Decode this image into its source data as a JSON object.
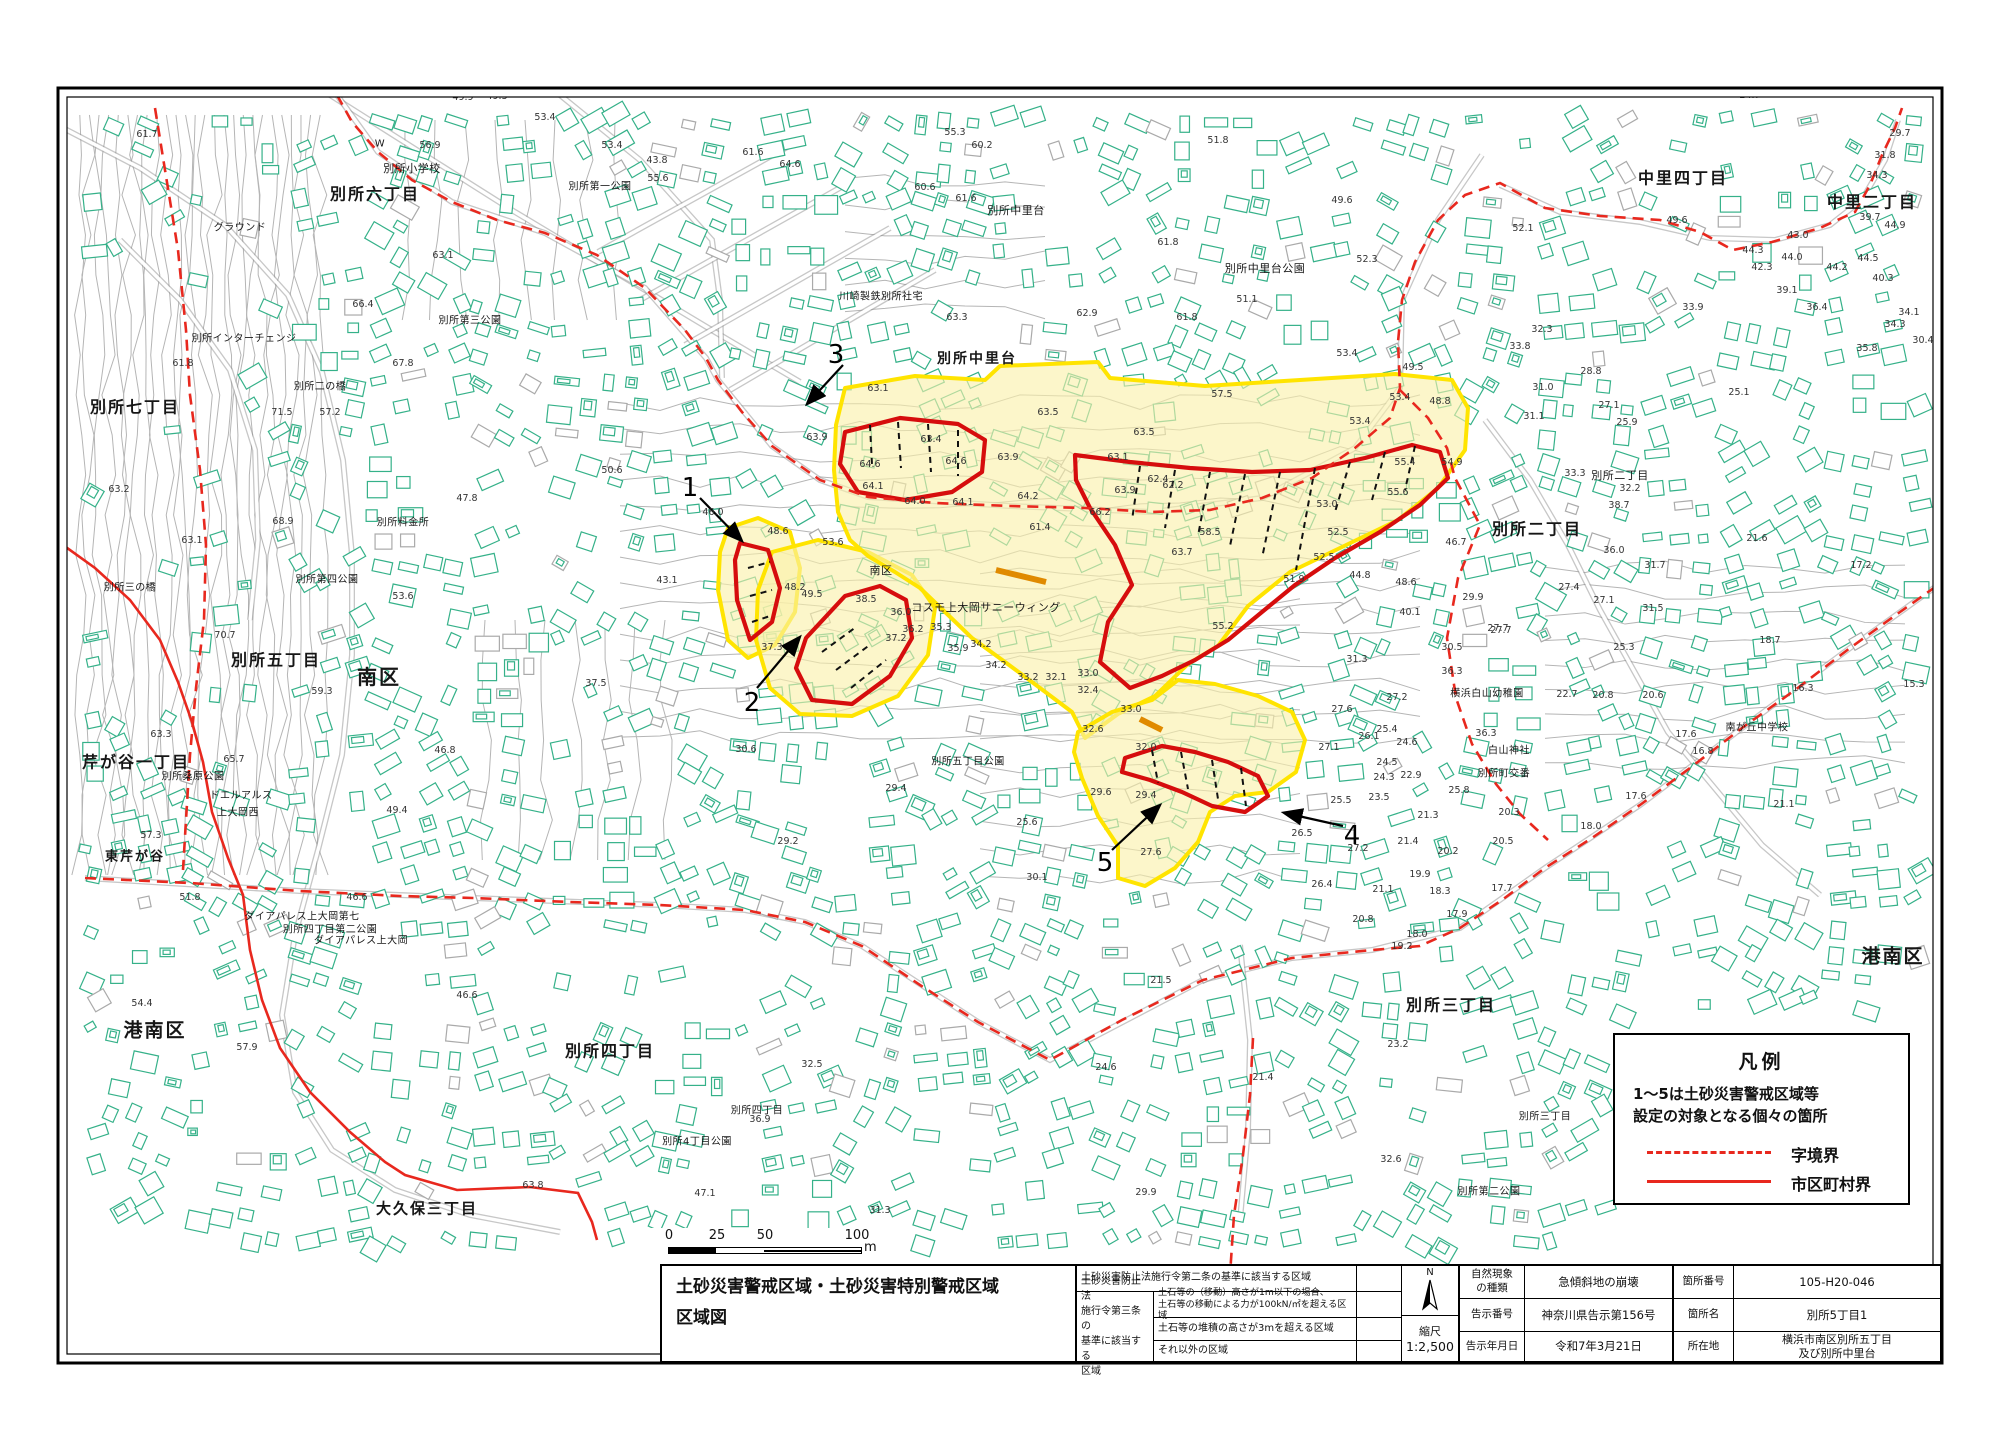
{
  "title": "土砂災害警戒区域等指定図（その2）",
  "scale_bar": {
    "t0": "0",
    "t25": "25",
    "t50": "50",
    "t100": "100",
    "unit": "m"
  },
  "legend_box": {
    "title": "凡例",
    "desc_line1": "1～5は土砂災害警戒区域等",
    "desc_line2": "設定の対象となる個々の箇所",
    "dashed_label": "字境界",
    "solid_label": "市区町村界"
  },
  "info_table": {
    "map_title_lines": [
      "土砂災害警戒区域・土砂災害特別警戒区域",
      "区域図"
    ],
    "row_article2": "土砂災害防止法施行令第二条の基準に該当する区域",
    "group_lines": [
      "土砂災害防止法",
      "施行令第三条の",
      "基準に該当する",
      "区域"
    ],
    "row_move_lines": [
      "土石等の（移動）高さが1m以下の場合、",
      "土石等の移動による力が100kN/㎡を超える区域"
    ],
    "row_deposit": "土石等の堆積の高さが3mを超える区域",
    "row_other": "それ以外の区域",
    "north_label": "N",
    "scale_label": "縮尺",
    "scale_value": "1:2,500",
    "nature_lines": [
      "自然現象",
      "の種類"
    ],
    "nature_value": "急傾斜地の崩壊",
    "notice_label": "告示番号",
    "notice_value": "神奈川県告示第156号",
    "date_label": "告示年月日",
    "date_value": "令和7年3月21日",
    "siteno_label": "箇所番号",
    "siteno_value": "105-H20-046",
    "sitename_label": "箇所名",
    "sitename_value": "別所5丁目1",
    "loc_label": "所在地",
    "loc_lines": [
      "横浜市南区別所五丁目",
      "及び別所中里台"
    ]
  },
  "map": {
    "area_labels": [
      [
        "別所小学校",
        412,
        168,
        11,
        0
      ],
      [
        "別所六丁目",
        375,
        194,
        16,
        1
      ],
      [
        "グラウンド",
        240,
        227,
        10,
        0
      ],
      [
        "別所第一公園",
        600,
        186,
        10,
        0
      ],
      [
        "別所第三公園",
        470,
        320,
        10,
        0
      ],
      [
        "別所インターチェンジ",
        244,
        338,
        10,
        0
      ],
      [
        "別所二の橋",
        320,
        386,
        10,
        0
      ],
      [
        "別所七丁目",
        135,
        407,
        16,
        1
      ],
      [
        "別所料金所",
        403,
        522,
        10,
        0
      ],
      [
        "別所第四公園",
        327,
        579,
        10,
        0
      ],
      [
        "別所三の橋",
        130,
        587,
        10,
        0
      ],
      [
        "別所五丁目",
        276,
        660,
        16,
        1
      ],
      [
        "南区",
        379,
        677,
        20,
        1
      ],
      [
        "芹が谷一丁目",
        136,
        762,
        16,
        1
      ],
      [
        "別所桑原公園",
        193,
        776,
        10,
        0
      ],
      [
        "ドエルアルス",
        241,
        795,
        10,
        0
      ],
      [
        "上大岡西",
        238,
        812,
        10,
        0
      ],
      [
        "東芹が谷",
        135,
        856,
        13,
        1
      ],
      [
        "ダイアパレス上大岡第七",
        302,
        916,
        10,
        0
      ],
      [
        "別所四丁目第二公園",
        330,
        929,
        10,
        0
      ],
      [
        "ダイアパレス上大岡",
        361,
        940,
        10,
        0
      ],
      [
        "港南区",
        155,
        1030,
        19,
        1
      ],
      [
        "大久保三丁目",
        427,
        1208,
        15,
        1
      ],
      [
        "別所四丁目",
        610,
        1051,
        16,
        1
      ],
      [
        "別所四丁目",
        757,
        1110,
        10,
        0
      ],
      [
        "別所4丁目公園",
        697,
        1141,
        10,
        0
      ],
      [
        "川崎製鉄別所社宅",
        881,
        296,
        10,
        0
      ],
      [
        "別所中里台",
        1016,
        210,
        11,
        0
      ],
      [
        "別所中里台",
        977,
        358,
        14,
        1
      ],
      [
        "別所中里台公園",
        1265,
        268,
        11,
        0
      ],
      [
        "コスモ上大岡サニーウィング",
        986,
        607,
        11,
        0
      ],
      [
        "南区",
        881,
        570,
        11,
        0
      ],
      [
        "別所五丁目公園",
        968,
        761,
        10,
        0
      ],
      [
        "横浜白山幼稚園",
        1487,
        693,
        10,
        0
      ],
      [
        "白山神社",
        1509,
        750,
        10,
        0
      ],
      [
        "別所町交番",
        1504,
        773,
        10,
        0
      ],
      [
        "南が丘中学校",
        1757,
        727,
        10,
        0
      ],
      [
        "中里四丁目",
        1683,
        178,
        16,
        1
      ],
      [
        "中里二丁目",
        1872,
        202,
        16,
        1
      ],
      [
        "別所二丁目",
        1537,
        529,
        16,
        1
      ],
      [
        "別所二丁目",
        1620,
        475,
        11,
        0
      ],
      [
        "別所三丁目",
        1451,
        1005,
        16,
        1
      ],
      [
        "別所三丁目",
        1545,
        1116,
        10,
        0
      ],
      [
        "別所第二公園",
        1489,
        1191,
        10,
        0
      ],
      [
        "港南区",
        1893,
        956,
        19,
        1
      ],
      [
        "W",
        380,
        143,
        10,
        0
      ]
    ],
    "spot_heights": [
      [
        "61.7",
        147,
        137
      ],
      [
        "56.9",
        430,
        148
      ],
      [
        "49.9",
        463,
        100
      ],
      [
        "49.3",
        497,
        99
      ],
      [
        "53.4",
        545,
        120
      ],
      [
        "53.4",
        612,
        148
      ],
      [
        "43.8",
        657,
        163
      ],
      [
        "55.6",
        658,
        181
      ],
      [
        "61.6",
        753,
        155
      ],
      [
        "64.6",
        790,
        167
      ],
      [
        "24.7",
        1750,
        98
      ],
      [
        "55.3",
        955,
        135
      ],
      [
        "60.2",
        982,
        148
      ],
      [
        "60.6",
        925,
        190
      ],
      [
        "61.6",
        966,
        201
      ],
      [
        "51.8",
        1218,
        143
      ],
      [
        "61.8",
        1168,
        245
      ],
      [
        "51.1",
        1247,
        302
      ],
      [
        "61.8",
        1187,
        320
      ],
      [
        "62.9",
        1087,
        316
      ],
      [
        "63.3",
        957,
        320
      ],
      [
        "52.3",
        1367,
        262
      ],
      [
        "49.6",
        1342,
        203
      ],
      [
        "53.4",
        1347,
        356
      ],
      [
        "29.7",
        1900,
        136
      ],
      [
        "31.8",
        1885,
        158
      ],
      [
        "34.3",
        1877,
        178
      ],
      [
        "52.1",
        1523,
        231
      ],
      [
        "49.6",
        1677,
        223
      ],
      [
        "44.3",
        1753,
        253
      ],
      [
        "44.0",
        1792,
        260
      ],
      [
        "43.0",
        1798,
        238
      ],
      [
        "42.3",
        1762,
        270
      ],
      [
        "44.2",
        1837,
        270
      ],
      [
        "44.5",
        1868,
        261
      ],
      [
        "44.9",
        1895,
        228
      ],
      [
        "39.7",
        1870,
        220
      ],
      [
        "40.3",
        1883,
        281
      ],
      [
        "39.1",
        1787,
        293
      ],
      [
        "36.4",
        1817,
        310
      ],
      [
        "33.9",
        1693,
        310
      ],
      [
        "34.3",
        1895,
        327
      ],
      [
        "34.1",
        1909,
        315
      ],
      [
        "30.4",
        1923,
        343
      ],
      [
        "35.8",
        1867,
        351
      ],
      [
        "25.1",
        1739,
        395
      ],
      [
        "32.3",
        1542,
        332
      ],
      [
        "33.8",
        1520,
        349
      ],
      [
        "28.8",
        1591,
        374
      ],
      [
        "31.0",
        1543,
        390
      ],
      [
        "27.1",
        1609,
        408
      ],
      [
        "25.9",
        1627,
        425
      ],
      [
        "31.1",
        1534,
        419
      ],
      [
        "63.1",
        443,
        258
      ],
      [
        "66.4",
        363,
        307
      ],
      [
        "67.8",
        403,
        366
      ],
      [
        "61.8",
        183,
        366
      ],
      [
        "63.2",
        119,
        492
      ],
      [
        "63.1",
        192,
        543
      ],
      [
        "68.9",
        283,
        524
      ],
      [
        "71.5",
        282,
        415
      ],
      [
        "57.2",
        330,
        415
      ],
      [
        "53.6",
        403,
        599
      ],
      [
        "59.3",
        322,
        694
      ],
      [
        "70.7",
        225,
        638
      ],
      [
        "47.8",
        467,
        501
      ],
      [
        "63.3",
        161,
        737
      ],
      [
        "65.7",
        234,
        762
      ],
      [
        "57.3",
        151,
        838
      ],
      [
        "51.8",
        190,
        900
      ],
      [
        "46.6",
        357,
        900
      ],
      [
        "49.4",
        397,
        813
      ],
      [
        "46.8",
        445,
        753
      ],
      [
        "54.4",
        142,
        1006
      ],
      [
        "57.9",
        247,
        1050
      ],
      [
        "46.6",
        467,
        998
      ],
      [
        "63.8",
        533,
        1188
      ],
      [
        "50.6",
        612,
        473
      ],
      [
        "46.0",
        713,
        515
      ],
      [
        "48.6",
        778,
        534
      ],
      [
        "43.1",
        667,
        583
      ],
      [
        "53.6",
        833,
        545
      ],
      [
        "37.5",
        596,
        686
      ],
      [
        "63.1",
        878,
        391
      ],
      [
        "63.9",
        817,
        440
      ],
      [
        "64.6",
        870,
        467
      ],
      [
        "64.1",
        873,
        489
      ],
      [
        "64.0",
        915,
        504
      ],
      [
        "64.1",
        963,
        505
      ],
      [
        "63.4",
        931,
        442
      ],
      [
        "64.6",
        956,
        464
      ],
      [
        "63.9",
        1008,
        460
      ],
      [
        "63.5",
        1048,
        415
      ],
      [
        "61.4",
        1040,
        530
      ],
      [
        "64.2",
        1028,
        499
      ],
      [
        "48.2",
        795,
        590
      ],
      [
        "49.5",
        812,
        597
      ],
      [
        "38.5",
        866,
        602
      ],
      [
        "36.0",
        901,
        615
      ],
      [
        "36.2",
        913,
        632
      ],
      [
        "37.2",
        896,
        641
      ],
      [
        "35.3",
        941,
        630
      ],
      [
        "35.9",
        958,
        651
      ],
      [
        "34.2",
        981,
        647
      ],
      [
        "34.2",
        996,
        668
      ],
      [
        "33.2",
        1028,
        680
      ],
      [
        "32.1",
        1056,
        680
      ],
      [
        "33.0",
        1088,
        676
      ],
      [
        "32.4",
        1088,
        693
      ],
      [
        "33.0",
        1131,
        712
      ],
      [
        "32.6",
        1093,
        732
      ],
      [
        "32.0",
        1146,
        750
      ],
      [
        "37.3",
        772,
        650
      ],
      [
        "30.6",
        746,
        752
      ],
      [
        "29.4",
        896,
        791
      ],
      [
        "29.2",
        788,
        844
      ],
      [
        "25.6",
        1027,
        825
      ],
      [
        "29.6",
        1101,
        795
      ],
      [
        "29.4",
        1146,
        798
      ],
      [
        "27.6",
        1151,
        855
      ],
      [
        "30.1",
        1037,
        880
      ],
      [
        "58.5",
        1210,
        535
      ],
      [
        "63.7",
        1182,
        555
      ],
      [
        "55.2",
        1223,
        629
      ],
      [
        "52.5",
        1324,
        560
      ],
      [
        "51.9",
        1294,
        582
      ],
      [
        "52.5",
        1338,
        535
      ],
      [
        "44.8",
        1360,
        578
      ],
      [
        "48.6",
        1406,
        585
      ],
      [
        "40.1",
        1410,
        615
      ],
      [
        "29.9",
        1473,
        600
      ],
      [
        "27.7",
        1498,
        631
      ],
      [
        "31.3",
        1357,
        662
      ],
      [
        "36.3",
        1452,
        674
      ],
      [
        "27.2",
        1397,
        700
      ],
      [
        "27.6",
        1342,
        712
      ],
      [
        "25.4",
        1387,
        732
      ],
      [
        "26.1",
        1369,
        739
      ],
      [
        "27.1",
        1329,
        750
      ],
      [
        "24.6",
        1407,
        745
      ],
      [
        "24.5",
        1387,
        765
      ],
      [
        "24.3",
        1384,
        780
      ],
      [
        "22.9",
        1411,
        778
      ],
      [
        "23.5",
        1379,
        800
      ],
      [
        "25.5",
        1341,
        803
      ],
      [
        "21.3",
        1428,
        818
      ],
      [
        "25.8",
        1459,
        793
      ],
      [
        "20.3",
        1509,
        815
      ],
      [
        "30.5",
        1452,
        650
      ],
      [
        "46.7",
        1456,
        545
      ],
      [
        "21.4",
        1408,
        844
      ],
      [
        "20.2",
        1448,
        854
      ],
      [
        "19.9",
        1420,
        877
      ],
      [
        "26.4",
        1322,
        887
      ],
      [
        "21.1",
        1383,
        892
      ],
      [
        "18.3",
        1440,
        894
      ],
      [
        "17.7",
        1502,
        891
      ],
      [
        "20.8",
        1363,
        922
      ],
      [
        "17.9",
        1457,
        917
      ],
      [
        "18.0",
        1417,
        937
      ],
      [
        "19.2",
        1402,
        949
      ],
      [
        "26.5",
        1302,
        836
      ],
      [
        "27.2",
        1358,
        851
      ],
      [
        "20.5",
        1503,
        844
      ],
      [
        "57.5",
        1222,
        397
      ],
      [
        "63.5",
        1144,
        435
      ],
      [
        "63.1",
        1118,
        460
      ],
      [
        "62.4",
        1158,
        482
      ],
      [
        "62.2",
        1173,
        488
      ],
      [
        "63.9",
        1125,
        493
      ],
      [
        "66.2",
        1100,
        515
      ],
      [
        "49.5",
        1413,
        370
      ],
      [
        "53.4",
        1400,
        400
      ],
      [
        "53.4",
        1360,
        424
      ],
      [
        "48.8",
        1440,
        404
      ],
      [
        "55.4",
        1405,
        465
      ],
      [
        "54.9",
        1452,
        465
      ],
      [
        "55.6",
        1398,
        495
      ],
      [
        "53.0",
        1327,
        507
      ],
      [
        "21.5",
        1161,
        983
      ],
      [
        "24.6",
        1106,
        1070
      ],
      [
        "21.4",
        1263,
        1080
      ],
      [
        "23.2",
        1398,
        1047
      ],
      [
        "32.6",
        1391,
        1162
      ],
      [
        "29.9",
        1146,
        1195
      ],
      [
        "20.6",
        1653,
        698
      ],
      [
        "20.8",
        1603,
        698
      ],
      [
        "22.7",
        1567,
        697
      ],
      [
        "25.3",
        1624,
        650
      ],
      [
        "31.5",
        1653,
        611
      ],
      [
        "31.7",
        1655,
        568
      ],
      [
        "36.0",
        1614,
        553
      ],
      [
        "38.7",
        1619,
        508
      ],
      [
        "32.2",
        1630,
        491
      ],
      [
        "33.3",
        1575,
        476
      ],
      [
        "21.6",
        1757,
        541
      ],
      [
        "17.2",
        1861,
        568
      ],
      [
        "18.7",
        1770,
        643
      ],
      [
        "27.4",
        1569,
        590
      ],
      [
        "27.1",
        1604,
        603
      ],
      [
        "27.7",
        1501,
        633
      ],
      [
        "36.3",
        1486,
        736
      ],
      [
        "15.3",
        1914,
        687
      ],
      [
        "16.3",
        1803,
        691
      ],
      [
        "17.6",
        1686,
        737
      ],
      [
        "16.8",
        1703,
        754
      ],
      [
        "17.6",
        1636,
        799
      ],
      [
        "18.0",
        1591,
        829
      ],
      [
        "21.1",
        1784,
        807
      ],
      [
        "36.9",
        760,
        1122
      ],
      [
        "47.1",
        705,
        1196
      ],
      [
        "32.5",
        812,
        1067
      ],
      [
        "31.3",
        880,
        1213
      ]
    ],
    "markers": [
      {
        "n": "1",
        "x": 690,
        "y": 487,
        "x1": 700,
        "y1": 498,
        "x2": 741,
        "y2": 540
      },
      {
        "n": "2",
        "x": 752,
        "y": 702,
        "x1": 757,
        "y1": 688,
        "x2": 799,
        "y2": 638
      },
      {
        "n": "3",
        "x": 836,
        "y": 354,
        "x1": 843,
        "y1": 365,
        "x2": 808,
        "y2": 403
      },
      {
        "n": "4",
        "x": 1352,
        "y": 835,
        "x1": 1343,
        "y1": 826,
        "x2": 1285,
        "y2": 813
      },
      {
        "n": "5",
        "x": 1105,
        "y": 862,
        "x1": 1112,
        "y1": 850,
        "x2": 1159,
        "y2": 806
      }
    ],
    "colors": {
      "building": "#35b189",
      "contour": "#b5b5b5",
      "road": "#8f8f8f",
      "boundary_red": "#e8281e",
      "zone_yellow": "#ffe400",
      "zone_fill": "#faf0aa",
      "special_red": "#d60d0d",
      "orange": "#e08a00"
    }
  }
}
